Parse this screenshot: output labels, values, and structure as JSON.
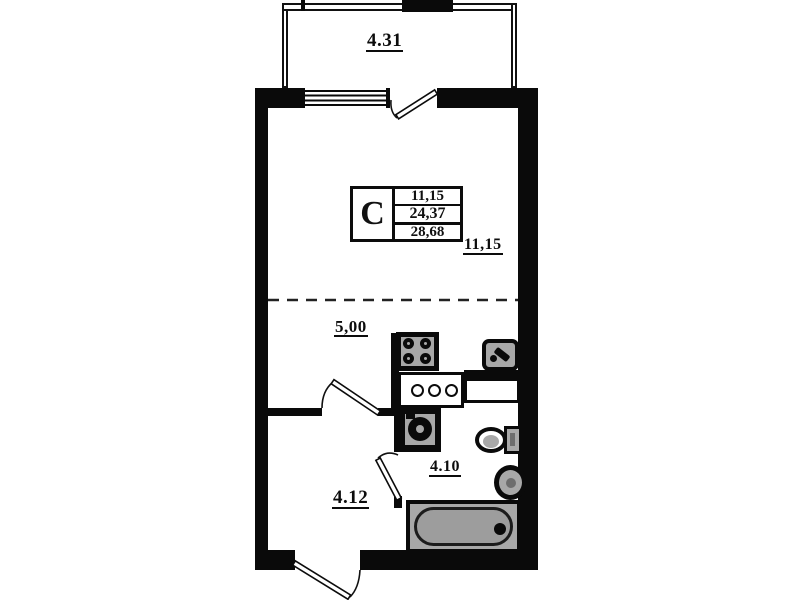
{
  "plan": {
    "title": "studio-apartment-floor-plan",
    "type_label": "C",
    "info_rows": [
      "11,15",
      "24,37",
      "28,68"
    ],
    "areas": {
      "balcony": "4.31",
      "room_dimension": "11,15",
      "kitchen_zone": "5,00",
      "bathroom": "4.10",
      "hallway": "4.12"
    },
    "colors": {
      "wall": "#0a0a0a",
      "background": "#ffffff",
      "fixture": "#a8a8a8",
      "tub": "#9d9d9d"
    },
    "icons": [
      "window-icon",
      "balcony-door-icon",
      "interior-door-icon",
      "bathroom-door-icon",
      "entry-door-icon",
      "stove-icon",
      "kitchen-sink-icon",
      "kitchen-counter-icon",
      "washing-machine-icon",
      "toilet-icon",
      "washbasin-icon",
      "bathtub-icon",
      "zone-divider-dashed-line"
    ]
  }
}
